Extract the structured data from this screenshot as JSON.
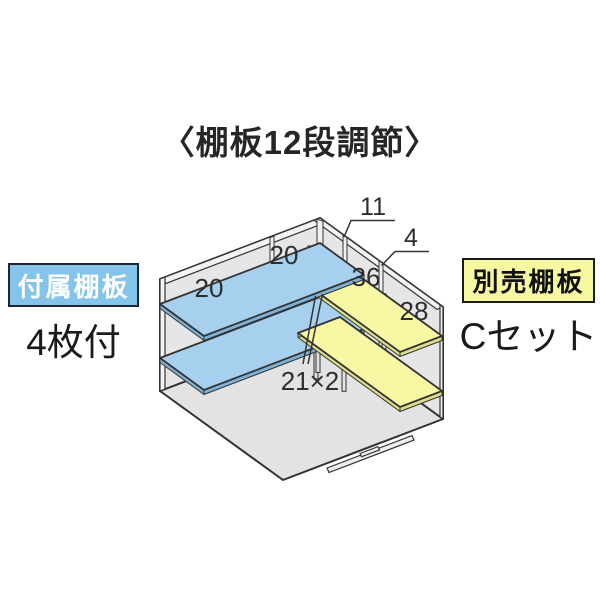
{
  "title": "〈棚板12段調節〉",
  "included": {
    "tag": "付属棚板",
    "note": "4枚付"
  },
  "optional": {
    "tag": "別売棚板",
    "note": "Cセット"
  },
  "diagram": {
    "labels": {
      "shelf_left_panel1": "20",
      "shelf_left_panel2": "20",
      "shelf_right_near": "36",
      "shelf_right_far": "28",
      "wall_dim_1": "11",
      "wall_dim_2": "4",
      "pitch": "21×2"
    },
    "colors": {
      "included_shelf": "#a6d0ee",
      "optional_shelf": "#f8f8a4",
      "wall": "#e6e6e6",
      "floor": "#e3e3e3",
      "outline": "#333333",
      "included_tag_bg": "#84c3ea",
      "optional_tag_bg": "#f8f8a0"
    }
  }
}
